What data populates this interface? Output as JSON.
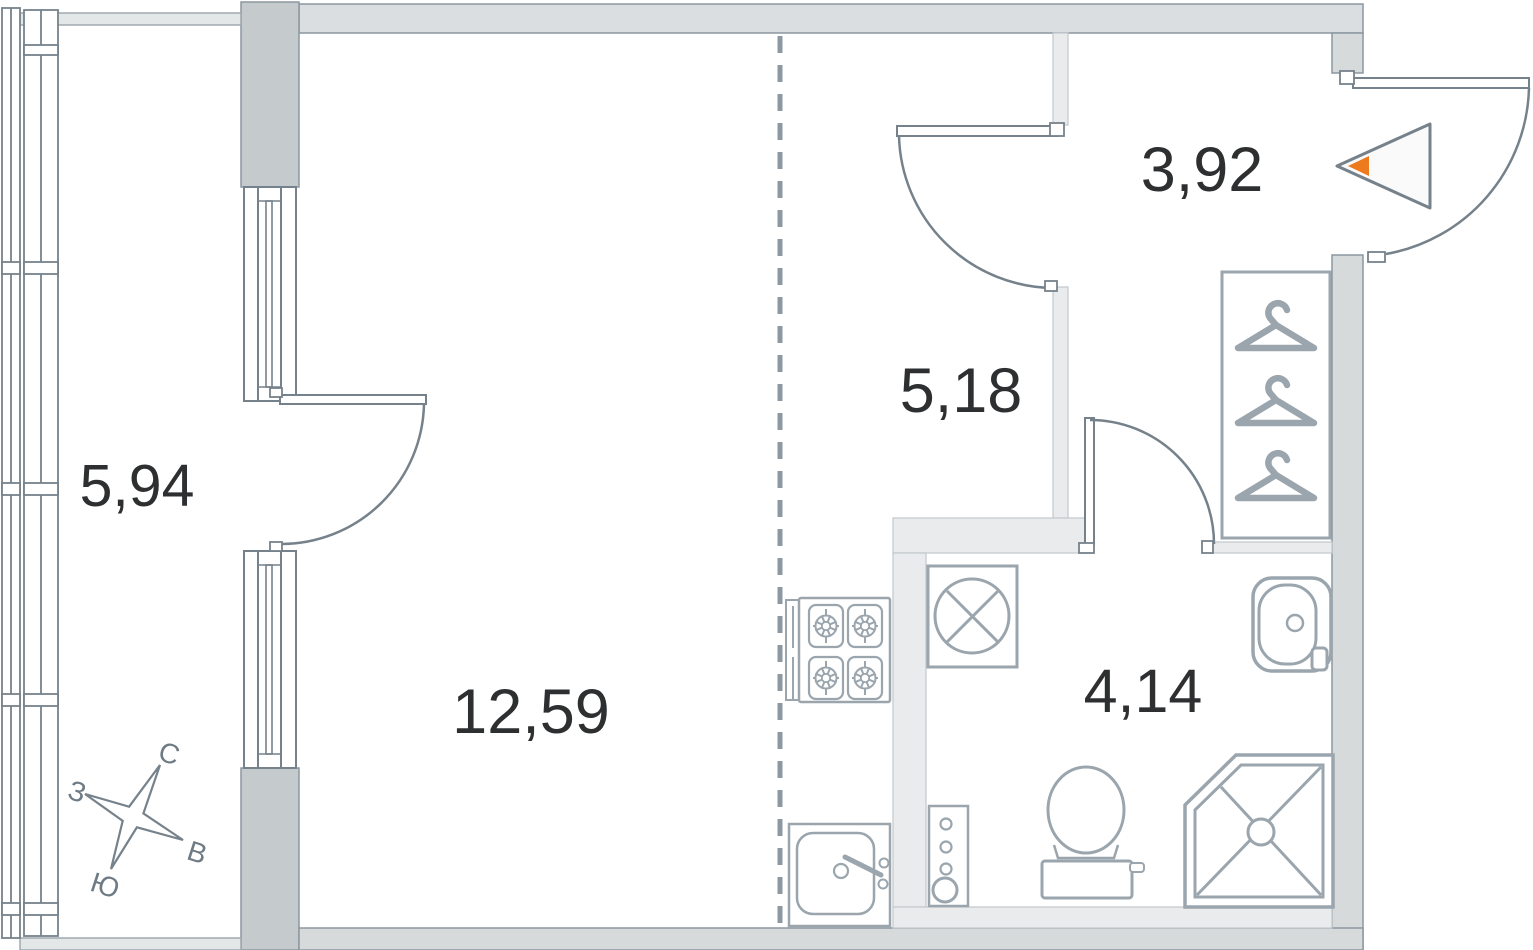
{
  "floorplan": {
    "rooms": [
      {
        "name": "balcony",
        "area": "5,94"
      },
      {
        "name": "living-room",
        "area": "12,59"
      },
      {
        "name": "kitchen",
        "area": "5,18"
      },
      {
        "name": "hallway",
        "area": "3,92"
      },
      {
        "name": "bathroom",
        "area": "4,14"
      }
    ],
    "compass": {
      "north": "С",
      "east": "В",
      "south": "Ю",
      "west": "З"
    },
    "colors": {
      "outer_wall": "#dbdee0",
      "pillar": "#c5cacc",
      "side_wall": "#d6dadb",
      "partition": "#e9ebec",
      "door_line": "#76828b",
      "fixture_line": "#9aa5ad",
      "dash_line": "#8d99a2",
      "label_text": "#2d2f30",
      "compass_text": "#6f7b84",
      "entrance_accent": "#ee7a1e"
    }
  }
}
